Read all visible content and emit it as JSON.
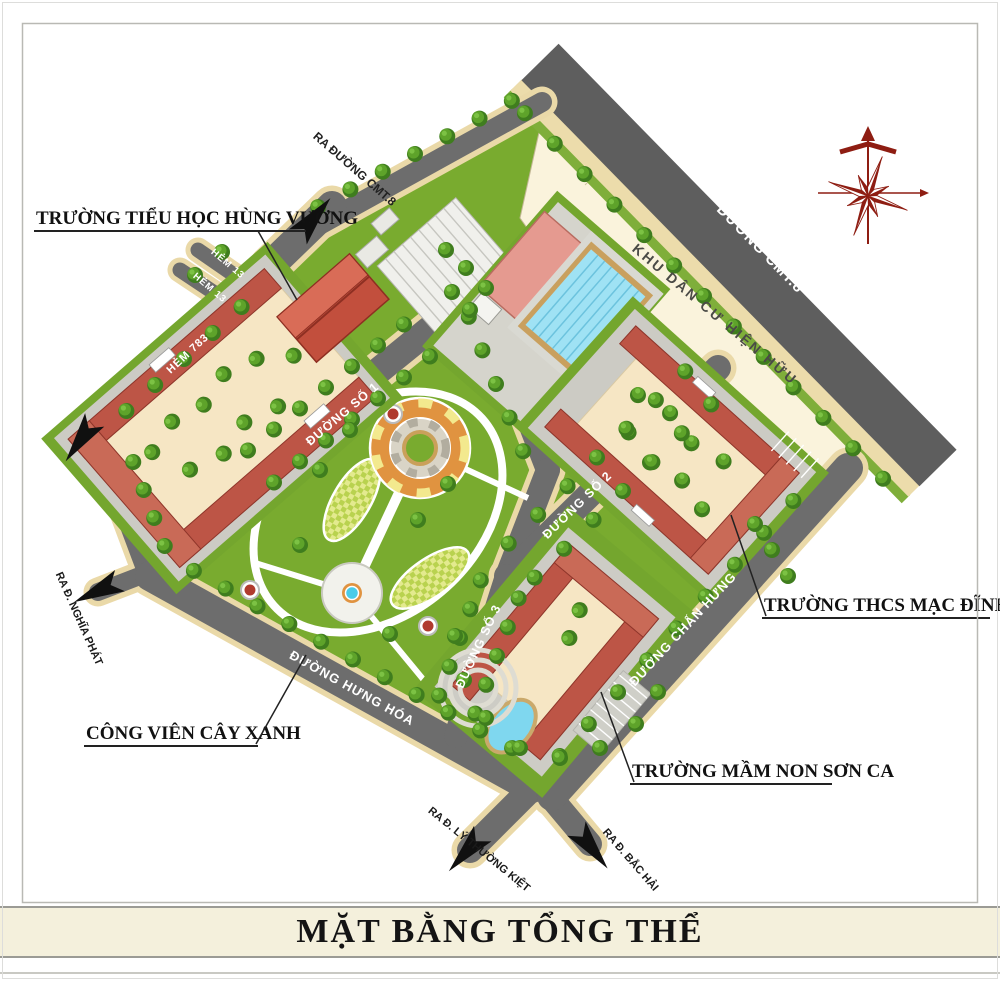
{
  "page": {
    "title": "MẶT BẰNG TỔNG THỂ"
  },
  "roads": {
    "cmt8": "ĐƯỜNG CMT.8",
    "ra_duong_cmt8": "RA ĐƯỜNG CMT.8",
    "hem_13_a": "HẺM 13",
    "hem_13_b": "HẺM 13",
    "hem_783": "HẺM 783",
    "duong_so_1": "ĐƯỜNG SỐ 1",
    "duong_so_2": "ĐƯỜNG SỐ 2",
    "duong_so_3": "ĐƯỜNG SỐ 3",
    "duong_chan_hung": "ĐƯỜNG CHẤN HƯNG",
    "duong_hung_hoa": "ĐƯỜNG HƯNG HÓA",
    "ra_d_nghia_phat": "RA Đ. NGHĨA PHÁT",
    "ra_d_ly_thuong_kiet": "RA Đ. LÝ THƯỜNG KIỆT",
    "ra_d_bac_hai": "RA Đ. BẮC HẢI"
  },
  "areas": {
    "khu_dan_cu": "KHU DÂN CƯ HIỆN HỮU",
    "truong_tieu_hoc": "TRƯỜNG TIỂU HỌC HÙNG VƯƠNG",
    "truong_thcs": "TRƯỜNG THCS MẠC ĐĨNH CHI",
    "cong_vien": "CÔNG VIÊN CÂY XANH",
    "truong_mam_non": "TRƯỜNG MẦM NON SƠN CA"
  },
  "colors": {
    "road": "#6d6d6d",
    "sidewalk": "#ead9a8",
    "grass": "#79ab2f",
    "building_red": "#bd5546",
    "courtyard": "#f6e6c4",
    "residential": "#faf3dc",
    "pool_blue": "#9fe2f4",
    "compass_red": "#8e1d12",
    "title_bg": "#f4f0dc"
  }
}
